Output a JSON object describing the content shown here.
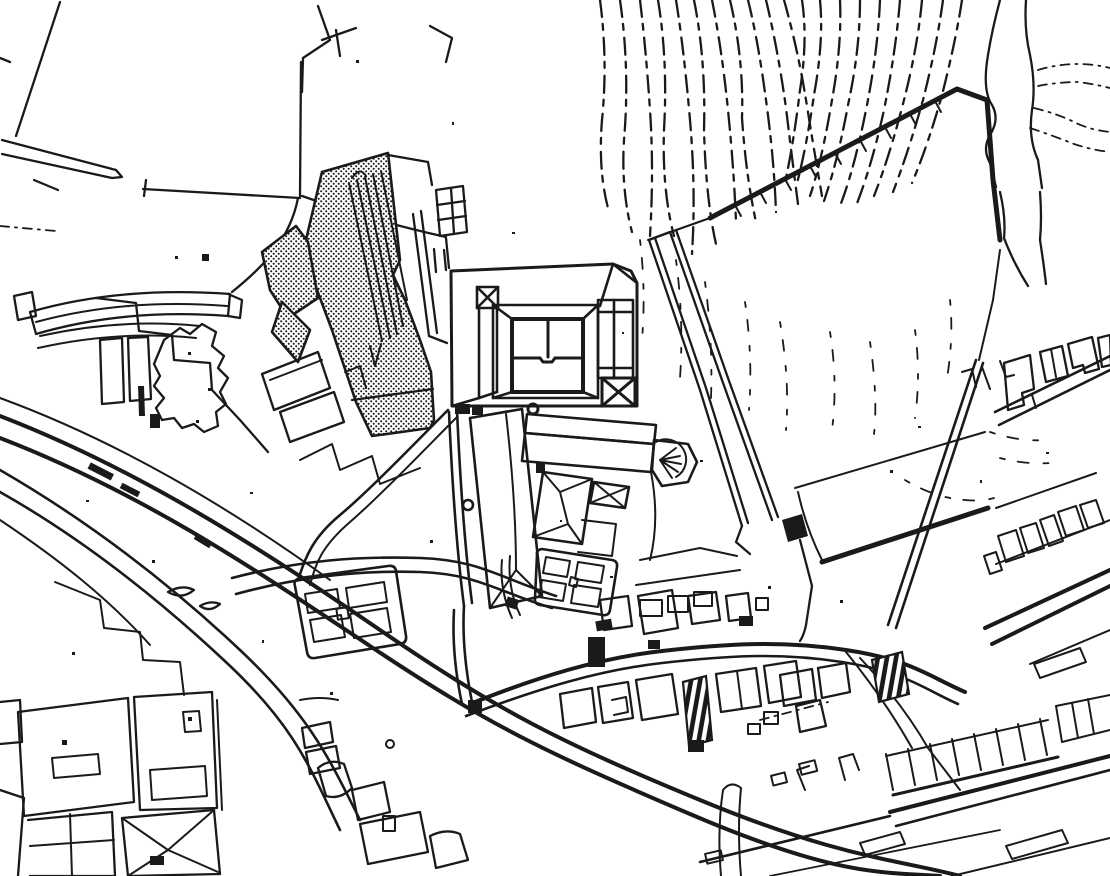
{
  "document": {
    "kind": "Scanned black-and-white town site plan (line drawing)",
    "view": "plan view of a hilltop castle precinct and surrounding town",
    "visible_text": []
  },
  "colors": {
    "paper": "#ffffff",
    "ink": "#1a1a1a"
  },
  "features": [
    {
      "id": "contour-lines",
      "label": "hillside contour lines"
    },
    {
      "id": "stream",
      "label": "stream gully with crossing path"
    },
    {
      "id": "boundary-wall",
      "label": "hilltop boundary wall with hachure ticks"
    },
    {
      "id": "castle-complex",
      "label": "castle with inner courtyard and X-marked corner towers"
    },
    {
      "id": "church-complex",
      "label": "church with apse, cloister ranges and garth parterre"
    },
    {
      "id": "stippled-building",
      "label": "large stippled (shaded) building complex with long halls"
    },
    {
      "id": "access-ramp",
      "label": "long double-walled access ramp with gate tower"
    },
    {
      "id": "formal-garden",
      "label": "four-quadrant formal garden with centre basin"
    },
    {
      "id": "street-network",
      "label": "curving town streets"
    },
    {
      "id": "town-blocks",
      "label": "town blocks and courtyard buildings"
    },
    {
      "id": "terraced-houses",
      "label": "rows of narrow terraced houses"
    },
    {
      "id": "stair-crossings",
      "label": "hatched stair crossings"
    },
    {
      "id": "garden-parcels",
      "label": "garden parcels and tree clump"
    },
    {
      "id": "field-boundaries",
      "label": "field boundaries north-west of the hill"
    },
    {
      "id": "scan-noise",
      "label": "scanner speckle"
    }
  ]
}
